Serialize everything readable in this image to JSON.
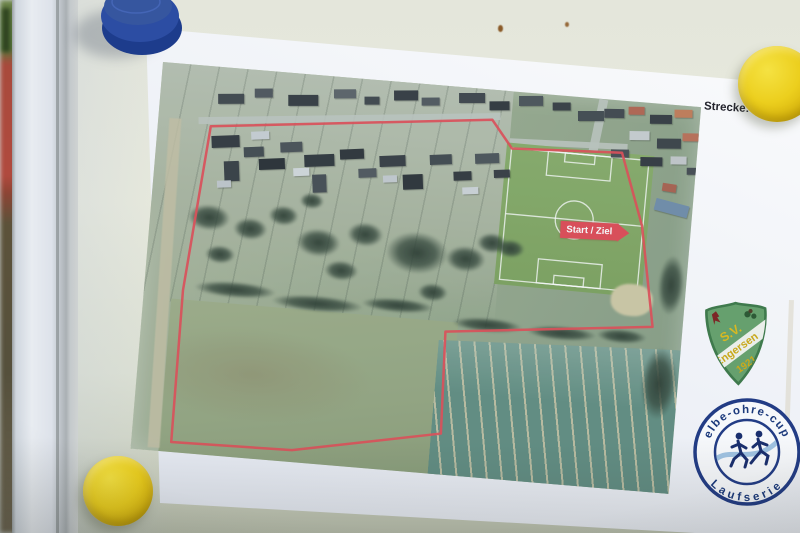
{
  "scene": {
    "distance_label": "Strecke:",
    "distance_value": "1 km"
  },
  "map": {
    "start_ziel_label": "Start / Ziel",
    "route_color": "#e2474f",
    "route_points": [
      [
        53,
        60
      ],
      [
        333,
        30
      ],
      [
        355,
        57
      ],
      [
        465,
        52
      ],
      [
        491,
        123
      ],
      [
        510,
        223
      ],
      [
        304,
        245
      ],
      [
        308,
        347
      ],
      [
        161,
        376
      ],
      [
        40,
        378
      ],
      [
        39,
        226
      ]
    ]
  },
  "shield_logo": {
    "initials": "S.V.",
    "club_name": "Engersen",
    "year": "1921"
  },
  "cup_logo": {
    "arc_top": "elbe-ohre-cup",
    "arc_bottom": "Laufserie"
  },
  "colors": {
    "magnet_blue": "#2c4da3",
    "magnet_yellow": "#e8ca18",
    "cup_navy": "#223c85",
    "shield_green": "#66a06e"
  }
}
